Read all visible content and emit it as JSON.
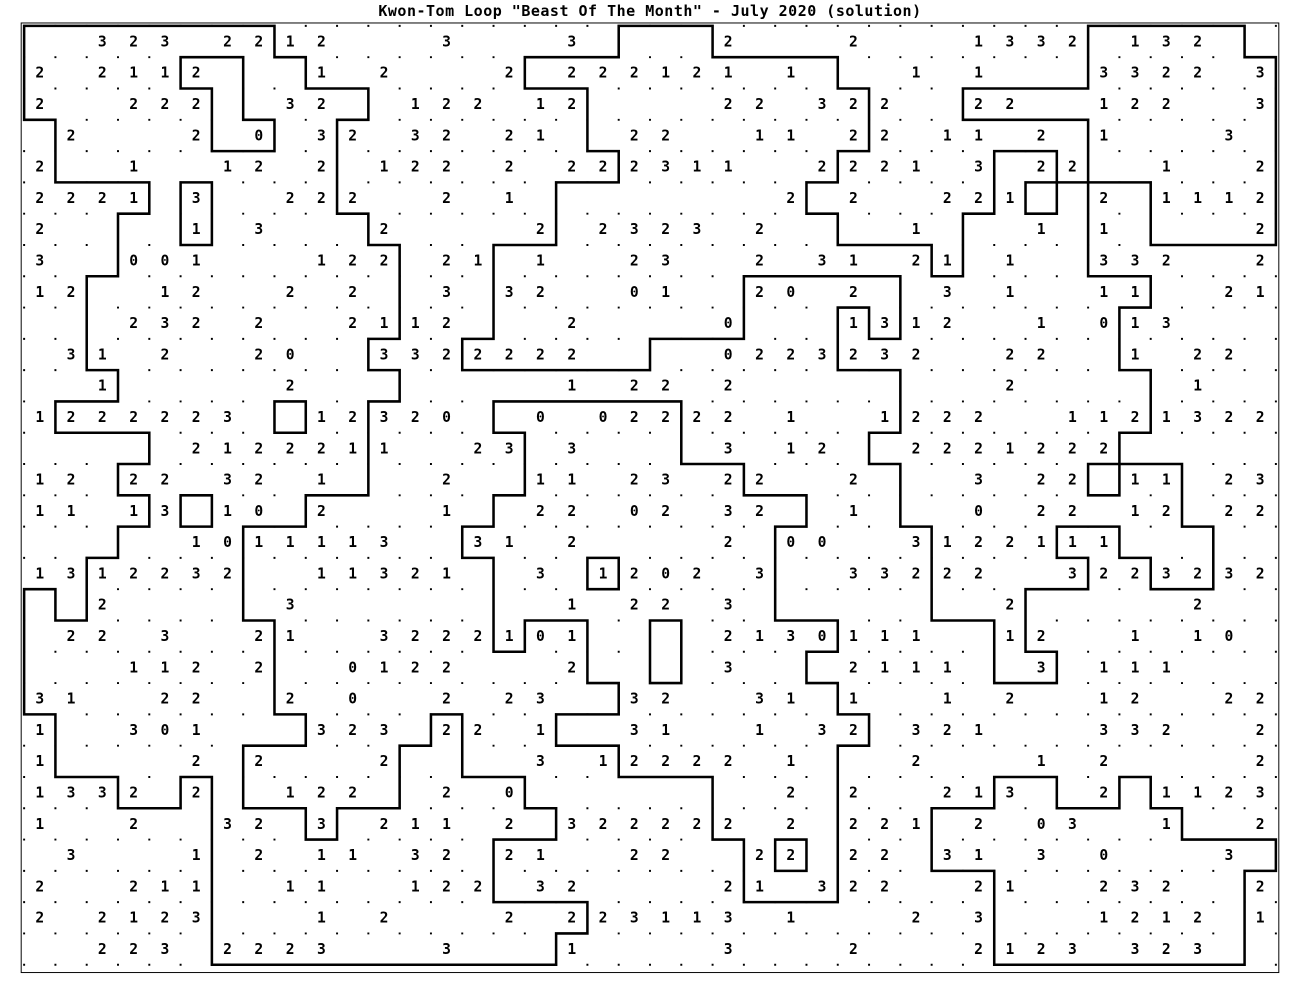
{
  "title": "Kwon-Tom Loop \"Beast Of The Month\" - July 2020 (solution)",
  "puzzle": {
    "name": "Kwon-Tom Loop",
    "edition": "Beast Of The Month",
    "date": "July 2020",
    "state": "solution"
  },
  "colors": {
    "ink": "#000000",
    "background": "#ffffff"
  },
  "board": {
    "rows": 30,
    "cols": 40,
    "empty_char": ".",
    "clue_rows": [
      "..323.2212...3...3....2...2...1332.132..",
      "2.2112...1.2...2.222121.1...1.1...3322.3",
      "2..222..32..122.12....22.322..22..122..3",
      ".2...2.0.32.32.21..22..11.22.11.2.1...3.",
      "2..1..12.2.122.2.222311..2221.3.22..1..2",
      "2221.3..222..2.1........2.2..221..2.1112",
      "2....1.3...2....2.2323.2....1...1.1....2",
      "3..001...122.21.1..23..2.31.21.1..332..2",
      "12..12..2.2..3.32..01..20.2..3.1..11..21",
      "...232.2..2112...2....0...1312..1.013...",
      ".31.2..20..3322222....0223232..22..1.22.",
      "..1.....2........1.22.2........2.....1..",
      "1222223..12320..0.02222.1..1222..1121322",
      ".....2122211..23.3....3.12..2221222.....",
      "12.22.32.1...2..11.23.22..2...3.22.11.23",
      "11.13.10.2...1..22.02.32..1...0.22.12.22",
      ".....1011113..31.2....2.00..3122111.....",
      "1312232..11321..3.1202.3..33222..3223232",
      "..2.....3........1.22.3........2.....2..",
      ".22.3..21..3222101....2130111..12..1.10.",
      "...112.2..0122...2....3...2111..3.111...",
      "31..22..2.0..2.23..32..31.1..1.2..12..22",
      "1..301...323.22.1..31..1.32.321...332..2",
      "1....2.2...2....3.12222.1...2...1.2....2",
      "1332.2..122..2.0........2.2..213..2.1123",
      "1..2..32.3.211.2.322222.2.221.2.03..1..2",
      ".3...1.2.11.32.21..22..22.22.31.3.0...3.",
      "2..211..11..122.32....21.322..21..232..2",
      "2.2123...1.2...2.223113.1...2.3...1212.1",
      "..223.2223...3...1....3...2...2123.323.."
    ]
  }
}
